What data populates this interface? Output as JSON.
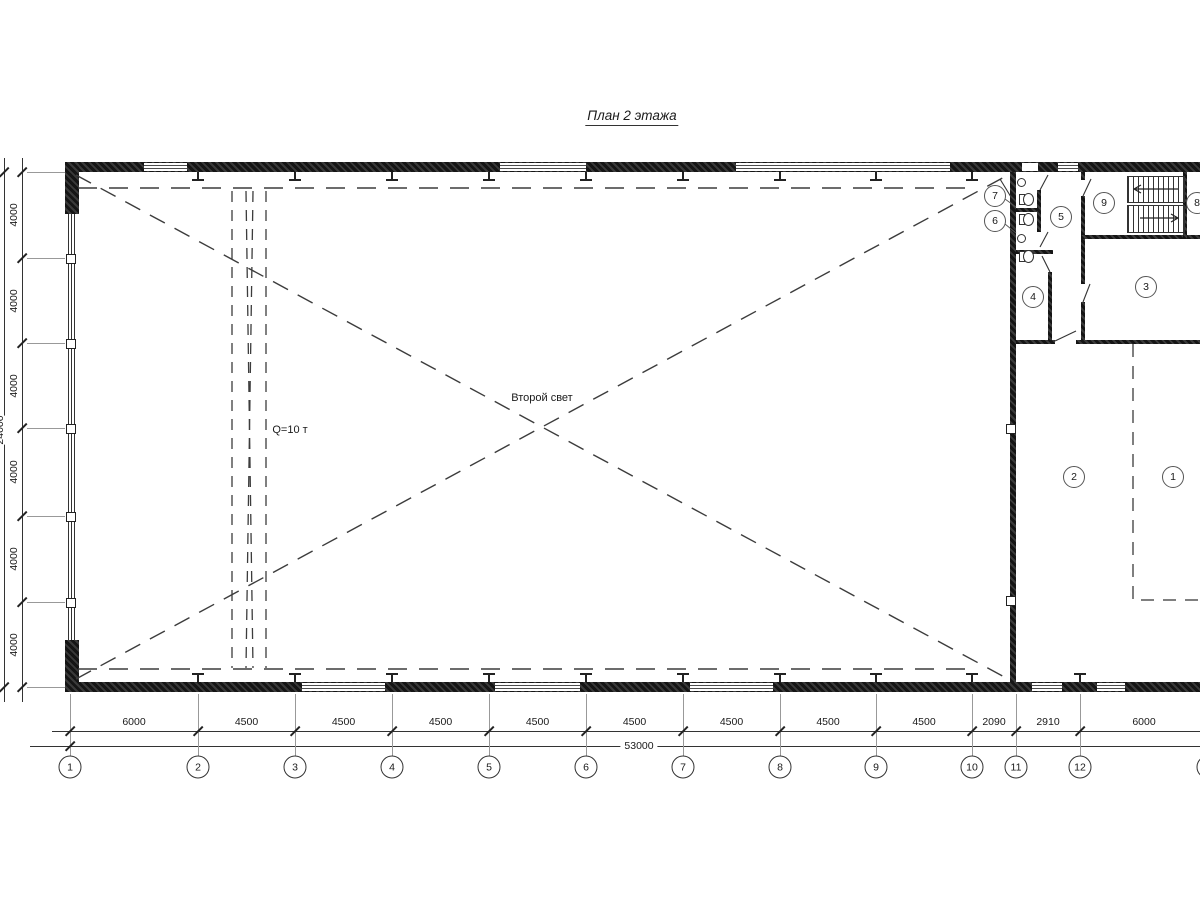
{
  "title": "План 2 этажа",
  "hall": {
    "label": "Второй свет",
    "crane_label": "Q=10 т"
  },
  "grid": {
    "axes": [
      {
        "n": "1",
        "x": 70
      },
      {
        "n": "2",
        "x": 198
      },
      {
        "n": "3",
        "x": 295
      },
      {
        "n": "4",
        "x": 392
      },
      {
        "n": "5",
        "x": 489
      },
      {
        "n": "6",
        "x": 586
      },
      {
        "n": "7",
        "x": 683
      },
      {
        "n": "8",
        "x": 780
      },
      {
        "n": "9",
        "x": 876
      },
      {
        "n": "10",
        "x": 972
      },
      {
        "n": "11",
        "x": 1016
      },
      {
        "n": "12",
        "x": 1080
      },
      {
        "n": "13",
        "x": 1208
      }
    ],
    "segments": [
      "6000",
      "4500",
      "4500",
      "4500",
      "4500",
      "4500",
      "4500",
      "4500",
      "4500",
      "2090",
      "2910",
      "6000"
    ],
    "total": "53000"
  },
  "left_dims": {
    "ticks_y": [
      172,
      258,
      343,
      428,
      516,
      602,
      687
    ],
    "segments": [
      "4000",
      "4000",
      "4000",
      "4000",
      "4000",
      "4000"
    ],
    "total": "24000"
  },
  "rooms": [
    {
      "n": "7",
      "x": 995,
      "y": 196
    },
    {
      "n": "6",
      "x": 995,
      "y": 221
    },
    {
      "n": "5",
      "x": 1061,
      "y": 217
    },
    {
      "n": "9",
      "x": 1104,
      "y": 203
    },
    {
      "n": "8",
      "x": 1197,
      "y": 203
    },
    {
      "n": "4",
      "x": 1033,
      "y": 297
    },
    {
      "n": "3",
      "x": 1146,
      "y": 287
    },
    {
      "n": "2",
      "x": 1074,
      "y": 477
    },
    {
      "n": "1",
      "x": 1173,
      "y": 477
    }
  ]
}
